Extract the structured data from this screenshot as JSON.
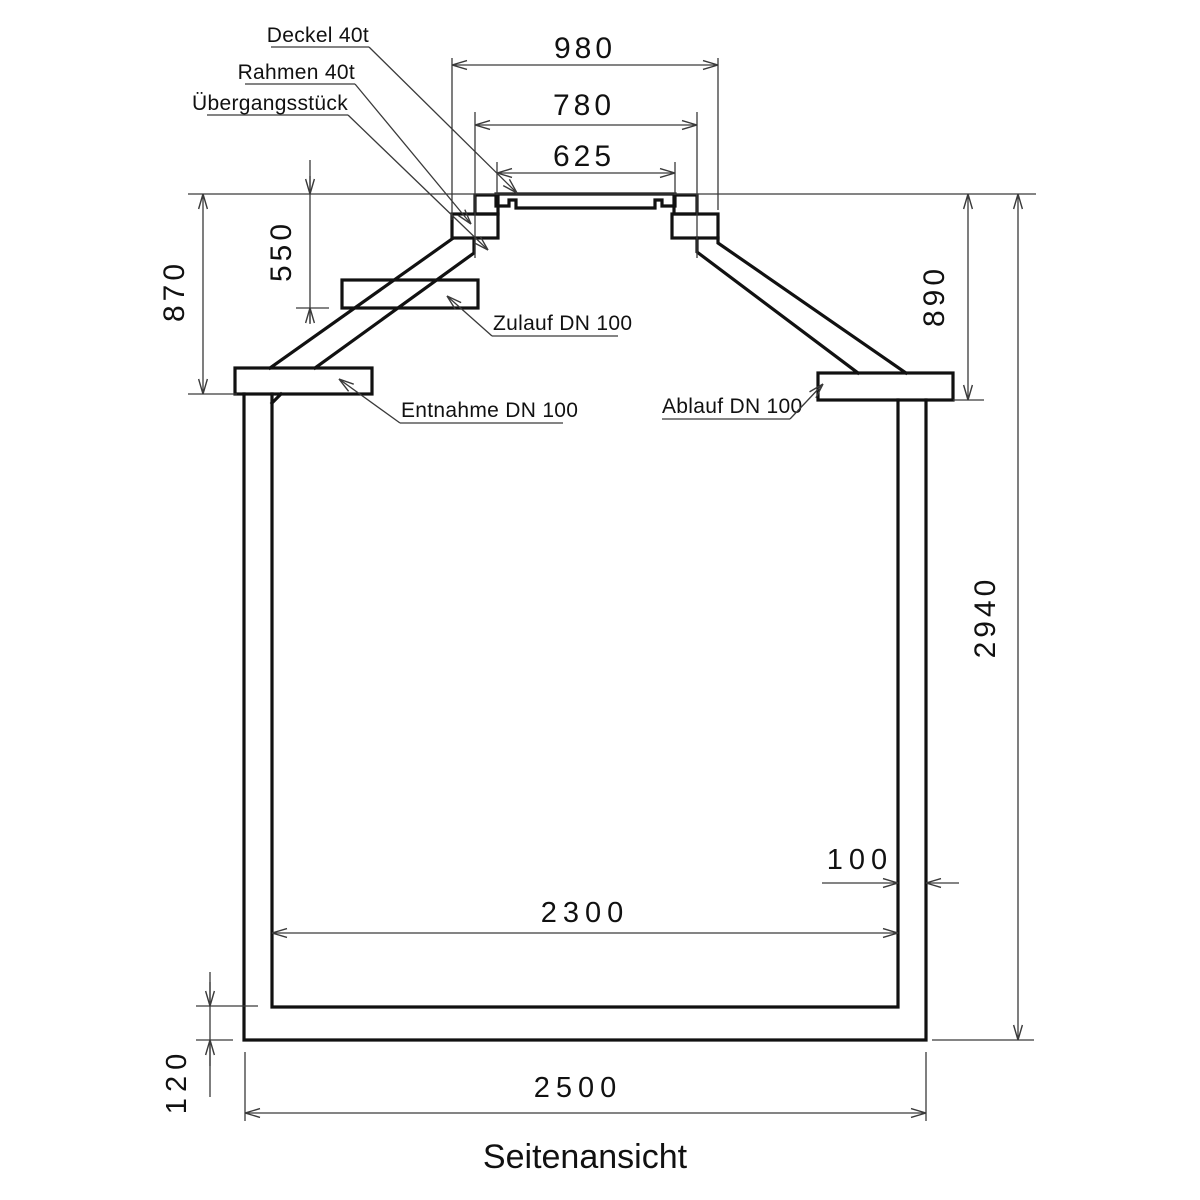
{
  "drawing": {
    "title": "Seitenansicht",
    "colors": {
      "outline": "#111111",
      "dimension_lines": "#3a3a3a",
      "background": "#ffffff"
    },
    "callouts": {
      "deckel": "Deckel 40t",
      "rahmen": "Rahmen 40t",
      "uebergangsstueck": "Übergangsstück",
      "zulauf": "Zulauf DN 100",
      "entnahme": "Entnahme DN 100",
      "ablauf": "Ablauf DN 100"
    },
    "dimensions": {
      "top_opening_outer": "980",
      "top_opening_mid": "780",
      "lid_width": "625",
      "inlet_invert_depth": "550",
      "left_shoulder_depth": "870",
      "right_shoulder_depth": "890",
      "total_height": "2940",
      "wall_thickness": "100",
      "inner_width": "2300",
      "outer_width": "2500",
      "floor_thickness": "120"
    }
  }
}
